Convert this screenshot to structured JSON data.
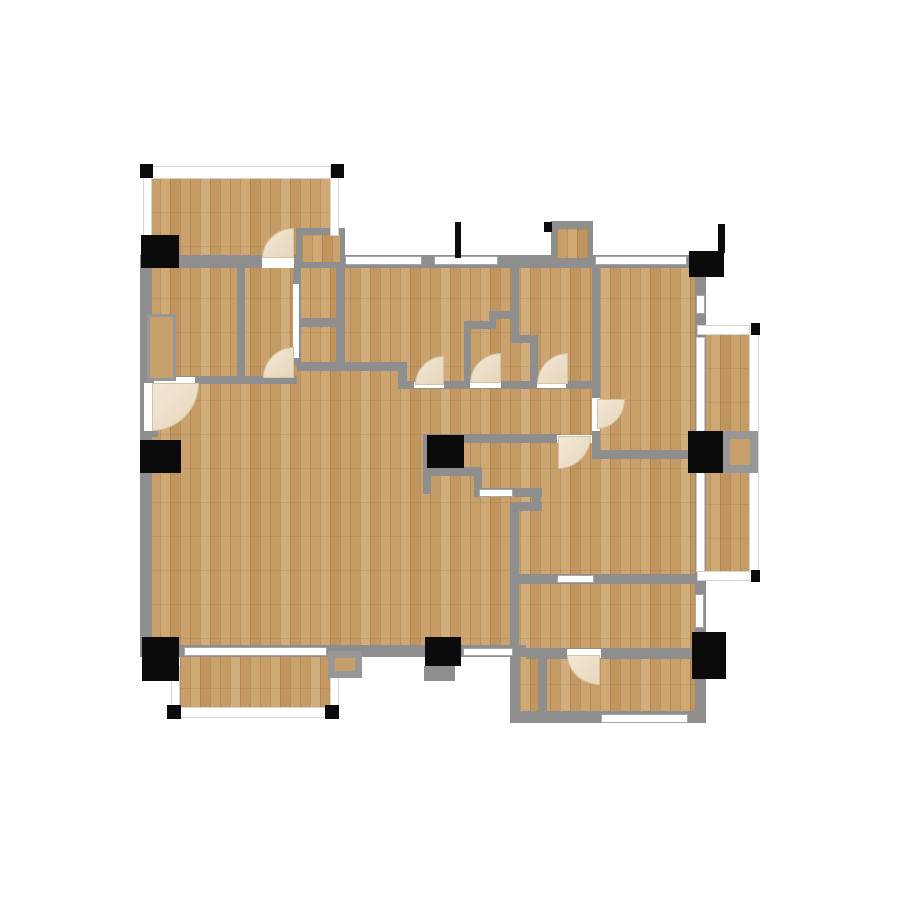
{
  "canvas": {
    "width": 900,
    "height": 900,
    "background": "#ffffff"
  },
  "colors": {
    "wall": "#8e8e8e",
    "floor_base": "#c59f6a",
    "floor_dark": "#c0955e",
    "floor_light": "#d2ac7a",
    "window_fill": "#ffffff",
    "window_frame": "#a6a6a6",
    "rail_fill": "#ffffff",
    "marker_black": "#0b0b0b",
    "door_arc_fill": "#ecdfc8",
    "frame_gray": "#979797"
  },
  "elements": {
    "floors": [
      [
        "floor-main",
        150,
        264,
        552,
        392
      ],
      [
        "floor-bottom-right-wing",
        510,
        650,
        193,
        70
      ],
      [
        "floor-balcony-top-left",
        150,
        178,
        185,
        84
      ],
      [
        "floor-balcony-right",
        700,
        334,
        54,
        240
      ],
      [
        "floor-balcony-bottom-left",
        180,
        654,
        152,
        58
      ]
    ],
    "walls": [
      [
        "wall-top",
        140,
        255,
        572,
        13
      ],
      [
        "wall-left",
        140,
        255,
        12,
        402
      ],
      [
        "wall-bottom-left",
        140,
        645,
        386,
        12
      ],
      [
        "wall-right",
        695,
        255,
        11,
        468
      ],
      [
        "wall-mid-bottom",
        526,
        648,
        176,
        11
      ],
      [
        "wall-bottom-right-wing",
        512,
        711,
        191,
        12
      ],
      [
        "wall-wing-left-outer",
        510,
        650,
        10,
        73
      ],
      [
        "wall-wing-left-inner",
        538,
        658,
        9,
        64
      ],
      [
        "wall-rooms-divider-h",
        517,
        574,
        186,
        10
      ],
      [
        "wall-living-right-v",
        510,
        506,
        9,
        148
      ],
      [
        "wall-living-conn",
        510,
        502,
        32,
        9
      ],
      [
        "wall-kitchen-stub",
        532,
        489,
        9,
        20
      ],
      [
        "wall-kitchen-left",
        423,
        434,
        8,
        60
      ],
      [
        "wall-kitchen-top",
        423,
        434,
        137,
        9
      ],
      [
        "wall-kitchen-bottom",
        423,
        467,
        59,
        9
      ],
      [
        "wall-kitchen-v",
        474,
        467,
        8,
        30
      ],
      [
        "wall-kitchen-counter",
        474,
        488,
        68,
        9
      ],
      [
        "wall-bedroom-divider-v",
        592,
        263,
        8,
        135
      ],
      [
        "wall-bedroom-divider-v2",
        592,
        430,
        8,
        24
      ],
      [
        "wall-hall-right-h",
        592,
        450,
        98,
        9
      ],
      [
        "wall-closet-v1",
        237,
        262,
        8,
        121
      ],
      [
        "wall-closet-v2",
        293,
        262,
        8,
        103
      ],
      [
        "wall-closet-v3",
        336,
        229,
        9,
        138
      ],
      [
        "wall-closet-h1",
        300,
        318,
        44,
        9
      ],
      [
        "wall-hall-top-left",
        150,
        376,
        147,
        8
      ],
      [
        "wall-hall-top-mid",
        297,
        362,
        110,
        9
      ],
      [
        "wall-hall-jog",
        398,
        362,
        9,
        27
      ],
      [
        "wall-hall-top-right",
        405,
        381,
        190,
        8
      ],
      [
        "wall-porch-top",
        296,
        228,
        49,
        8
      ],
      [
        "wall-porch-left",
        296,
        228,
        8,
        35
      ],
      [
        "wall-chimney-top",
        551,
        221,
        42,
        9
      ],
      [
        "wall-chimney-left",
        551,
        221,
        8,
        44
      ],
      [
        "wall-chimney-right",
        584,
        221,
        9,
        44
      ],
      [
        "wall-step-v1",
        511,
        264,
        8,
        79
      ],
      [
        "wall-step-h1",
        489,
        311,
        30,
        8
      ],
      [
        "wall-step-v2",
        489,
        311,
        7,
        17
      ],
      [
        "wall-step-h2",
        464,
        321,
        32,
        8
      ],
      [
        "wall-step-v3",
        464,
        321,
        7,
        62
      ],
      [
        "wall-step-h3",
        511,
        335,
        27,
        8
      ],
      [
        "wall-step-v4",
        530,
        343,
        8,
        40
      ],
      [
        "wall-apron-bottom",
        424,
        666,
        31,
        15
      ],
      [
        "wall-entry-jamb",
        146,
        429,
        12,
        8
      ]
    ],
    "floors2": [
      [
        "floor-porch-nook",
        302,
        235,
        38,
        27
      ],
      [
        "floor-chimney",
        557,
        229,
        31,
        29
      ]
    ],
    "rails": [
      [
        "rail-balcony-tl-top",
        143,
        166,
        196,
        13
      ],
      [
        "rail-balcony-tl-left",
        143,
        166,
        9,
        92
      ],
      [
        "rail-balcony-tl-right",
        330,
        166,
        9,
        70
      ],
      [
        "rail-balcony-r-top",
        697,
        325,
        62,
        10
      ],
      [
        "rail-balcony-r-right",
        749,
        325,
        10,
        256
      ],
      [
        "rail-balcony-r-bottom",
        697,
        571,
        62,
        10
      ],
      [
        "rail-balcony-bl-left",
        171,
        666,
        9,
        52
      ],
      [
        "rail-balcony-bl-bottom",
        171,
        707,
        168,
        11
      ],
      [
        "rail-balcony-bl-right",
        330,
        672,
        9,
        46
      ]
    ],
    "windows": [
      [
        "window-top-1",
        345,
        256,
        77,
        9
      ],
      [
        "window-top-2",
        434,
        256,
        64,
        9
      ],
      [
        "window-top-3",
        595,
        256,
        92,
        9
      ],
      [
        "window-bottom-1",
        184,
        647,
        143,
        9
      ],
      [
        "window-bottom-2",
        463,
        648,
        50,
        8
      ],
      [
        "window-right-1",
        696,
        295,
        9,
        19
      ],
      [
        "window-right-2",
        695,
        594,
        9,
        34
      ],
      [
        "window-wing-bottom",
        601,
        714,
        87,
        9
      ],
      [
        "window-divider-h",
        557,
        575,
        37,
        8
      ],
      [
        "window-kitchen",
        479,
        489,
        34,
        8
      ]
    ],
    "glass": [
      [
        "glass-door-right-1",
        696,
        337,
        9,
        96
      ],
      [
        "glass-door-right-2",
        696,
        472,
        9,
        100
      ]
    ],
    "openings": [
      [
        "opening-balcony-door",
        262,
        256,
        32,
        12
      ],
      [
        "opening-hall-left",
        154,
        377,
        41,
        6
      ],
      [
        "opening-entry-door",
        144,
        383,
        8,
        48
      ],
      [
        "opening-hall-1",
        414,
        382,
        30,
        6
      ],
      [
        "opening-hall-2",
        470,
        382,
        31,
        6
      ],
      [
        "opening-hall-3",
        537,
        382,
        29,
        6
      ],
      [
        "opening-bedroom-door",
        592,
        398,
        8,
        33
      ],
      [
        "opening-kitchen-door",
        557,
        435,
        35,
        8
      ],
      [
        "opening-wing-door",
        567,
        649,
        34,
        9
      ],
      [
        "opening-closet-slider",
        293,
        284,
        6,
        74
      ]
    ],
    "grayboxes": [
      [
        "frame-box-right-balcony",
        722,
        431,
        36,
        42,
        8
      ],
      [
        "frame-box-bottom-left",
        328,
        651,
        34,
        27,
        7
      ],
      [
        "frame-niche-left",
        147,
        314,
        29,
        67,
        3
      ]
    ],
    "blacks": [
      [
        "marker-left-top",
        141,
        235,
        38,
        33
      ],
      [
        "marker-left-mid",
        140,
        440,
        41,
        33
      ],
      [
        "marker-left-bottom",
        142,
        637,
        37,
        44
      ],
      [
        "marker-bottom-center",
        425,
        637,
        36,
        29
      ],
      [
        "marker-top-right-box",
        689,
        251,
        35,
        26
      ],
      [
        "marker-top-right-flag",
        718,
        224,
        7,
        29
      ],
      [
        "marker-right-mid",
        688,
        431,
        35,
        42
      ],
      [
        "marker-right-bottom",
        692,
        632,
        34,
        47
      ],
      [
        "marker-kitchen-appliance",
        427,
        435,
        37,
        33
      ],
      [
        "marker-top-flag",
        455,
        222,
        6,
        36
      ],
      [
        "marker-chimney-tick",
        544,
        222,
        8,
        10
      ],
      [
        "marker-corner-balcony-tl-1",
        140,
        164,
        13,
        14
      ],
      [
        "marker-corner-balcony-tl-2",
        331,
        164,
        13,
        14
      ],
      [
        "marker-corner-balcony-r-1",
        751,
        323,
        9,
        12
      ],
      [
        "marker-corner-balcony-r-2",
        751,
        570,
        9,
        12
      ],
      [
        "marker-corner-balcony-bl-1",
        167,
        705,
        14,
        14
      ],
      [
        "marker-corner-balcony-bl-2",
        325,
        705,
        14,
        14
      ]
    ],
    "arcs": [
      [
        "door-arc-balcony",
        262,
        228,
        32,
        30,
        "tl"
      ],
      [
        "door-arc-entry",
        152,
        383,
        47,
        48,
        "br"
      ],
      [
        "door-arc-closet",
        263,
        347,
        31,
        31,
        "tl"
      ],
      [
        "door-arc-hall-1",
        415,
        356,
        29,
        29,
        "tl"
      ],
      [
        "door-arc-hall-2",
        470,
        353,
        31,
        30,
        "tl"
      ],
      [
        "door-arc-hall-3",
        537,
        353,
        31,
        31,
        "tl"
      ],
      [
        "door-arc-kitchen",
        558,
        436,
        33,
        33,
        "br"
      ],
      [
        "door-arc-living",
        597,
        399,
        28,
        30,
        "br"
      ],
      [
        "door-arc-wing-room",
        567,
        655,
        33,
        30,
        "bl"
      ]
    ]
  }
}
